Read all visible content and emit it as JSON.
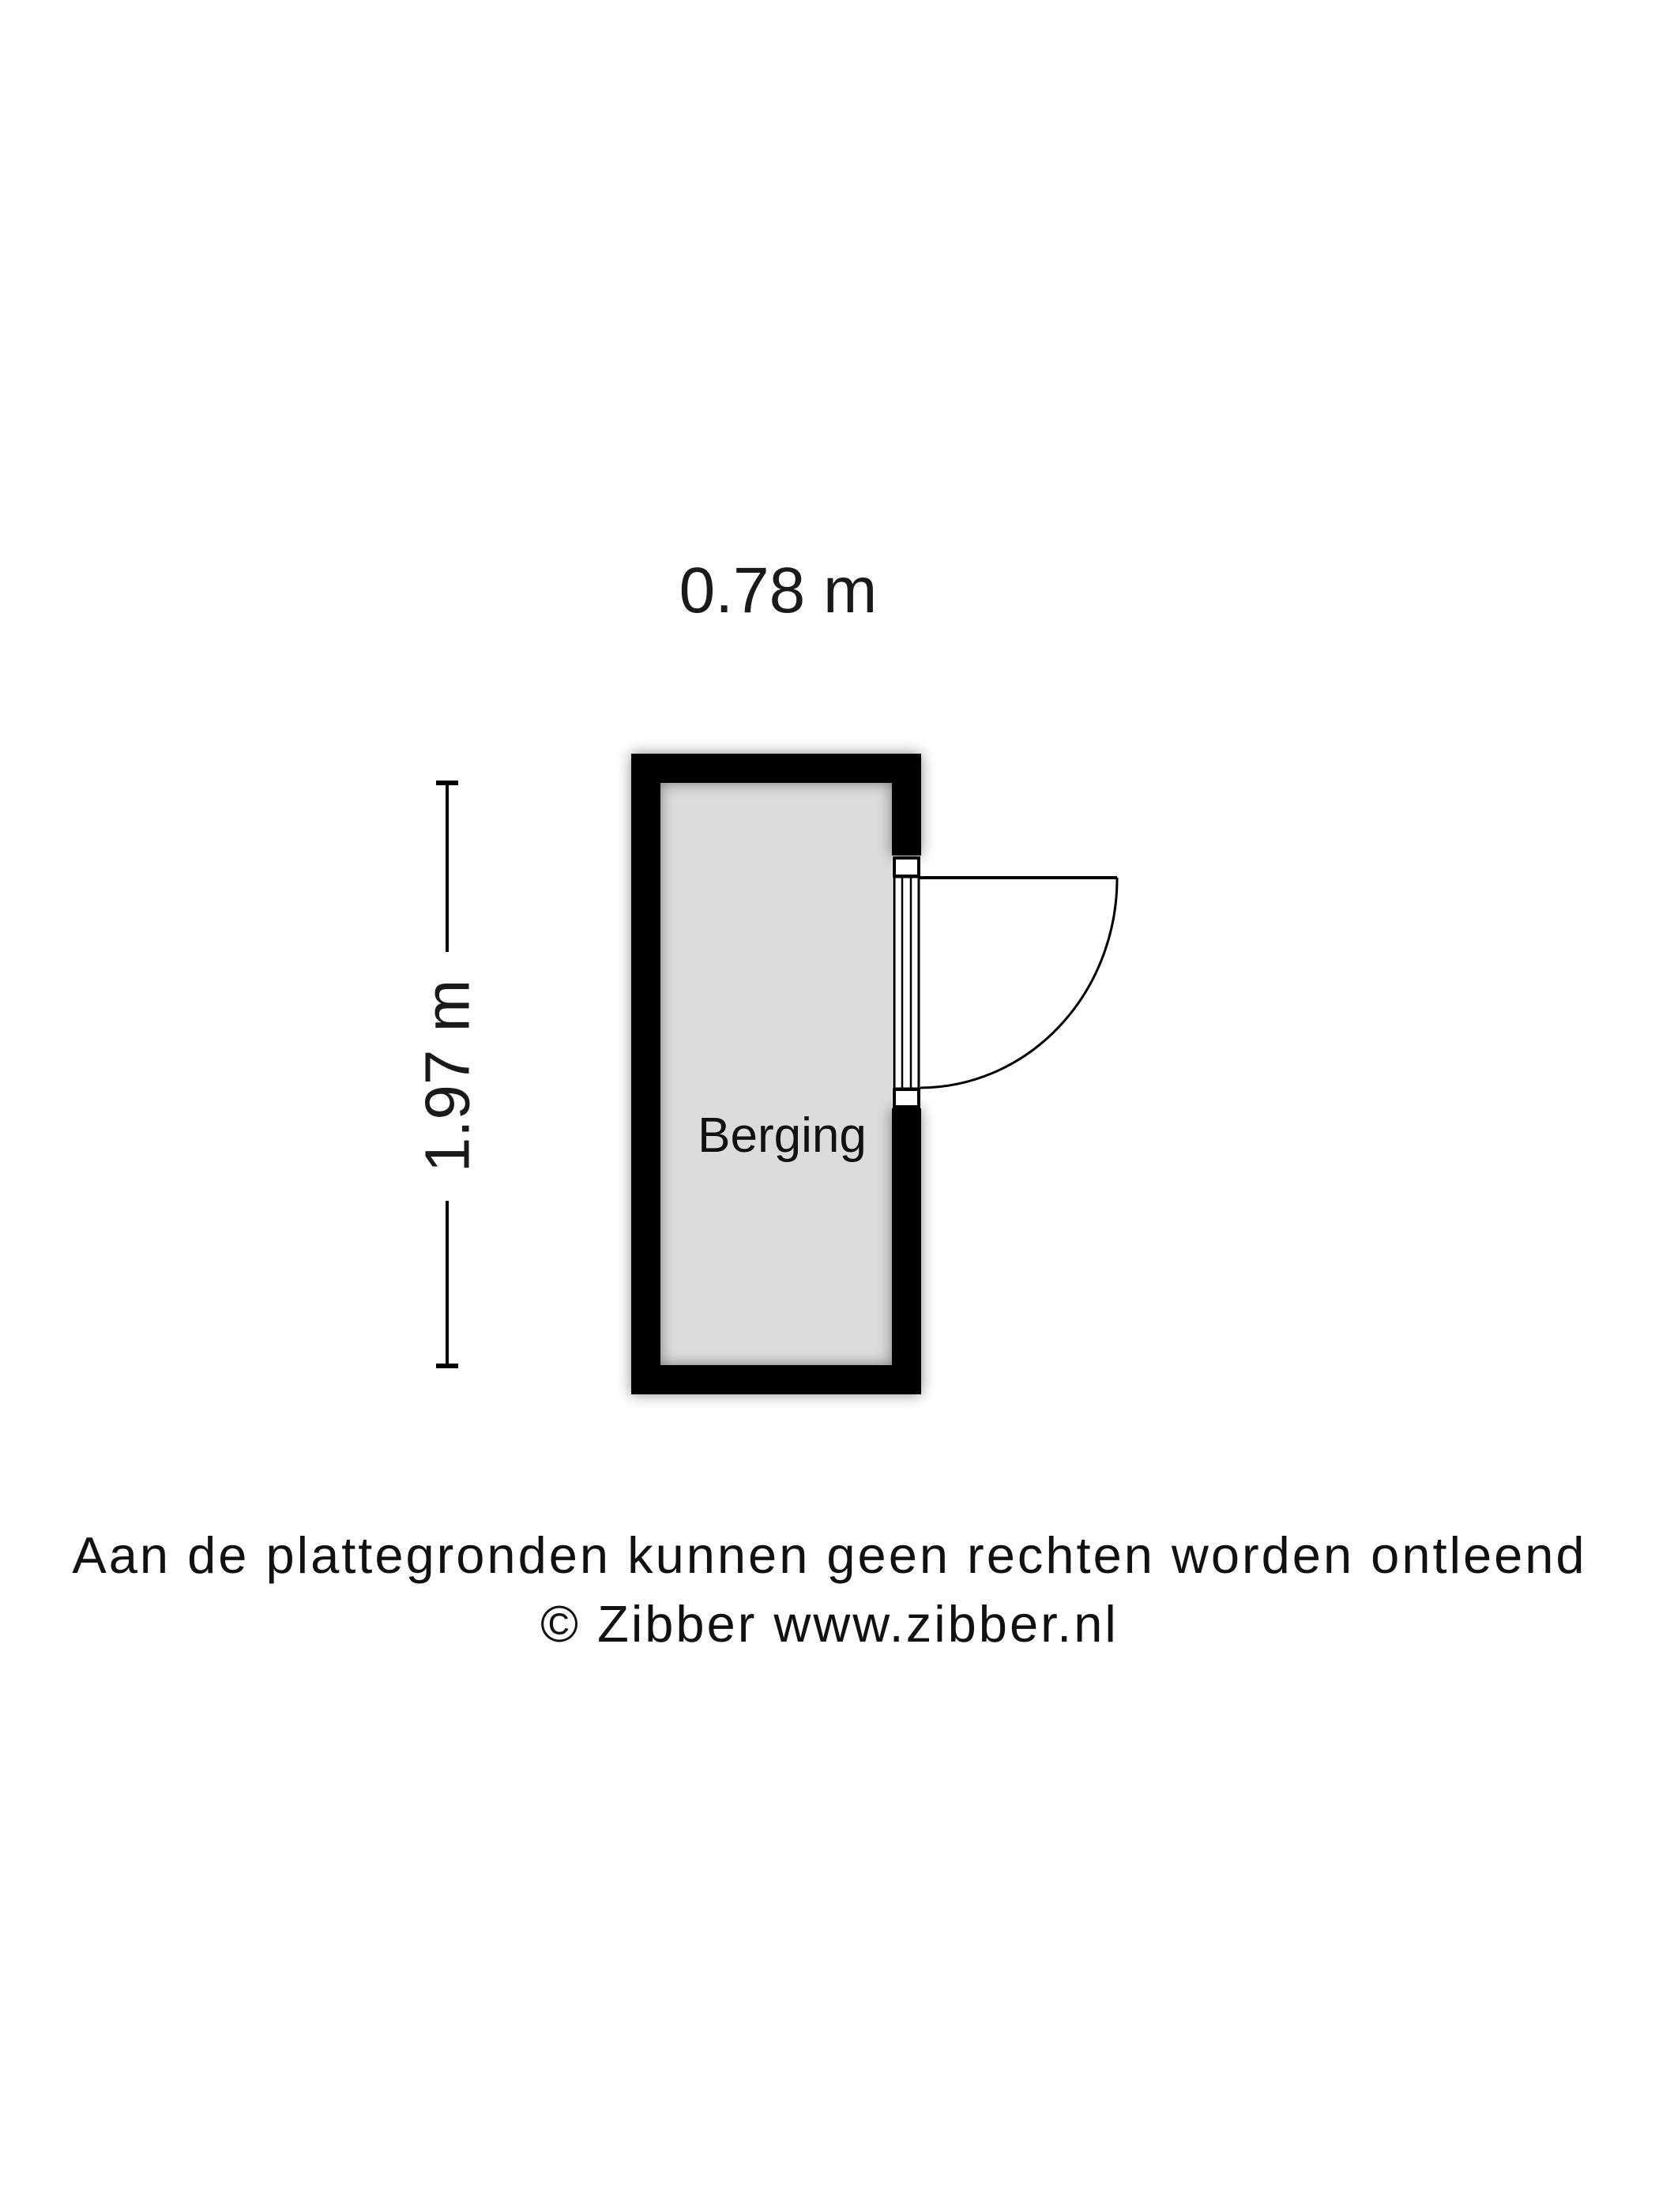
{
  "colors": {
    "background": "#ffffff",
    "wall": "#000000",
    "floor": "#dcdcdc",
    "line": "#000000"
  },
  "floorplan": {
    "room": {
      "name": "Berging"
    },
    "dimensions": {
      "width": {
        "label": "0.78 m"
      },
      "height": {
        "label": "1.97 m"
      }
    },
    "door": {
      "type": "single-swing-door",
      "location": "right-wall",
      "swing": "outward-right"
    }
  },
  "footer": {
    "line1": "Aan de plattegronden kunnen geen rechten worden ontleend",
    "line2": "© Zibber www.zibber.nl"
  }
}
